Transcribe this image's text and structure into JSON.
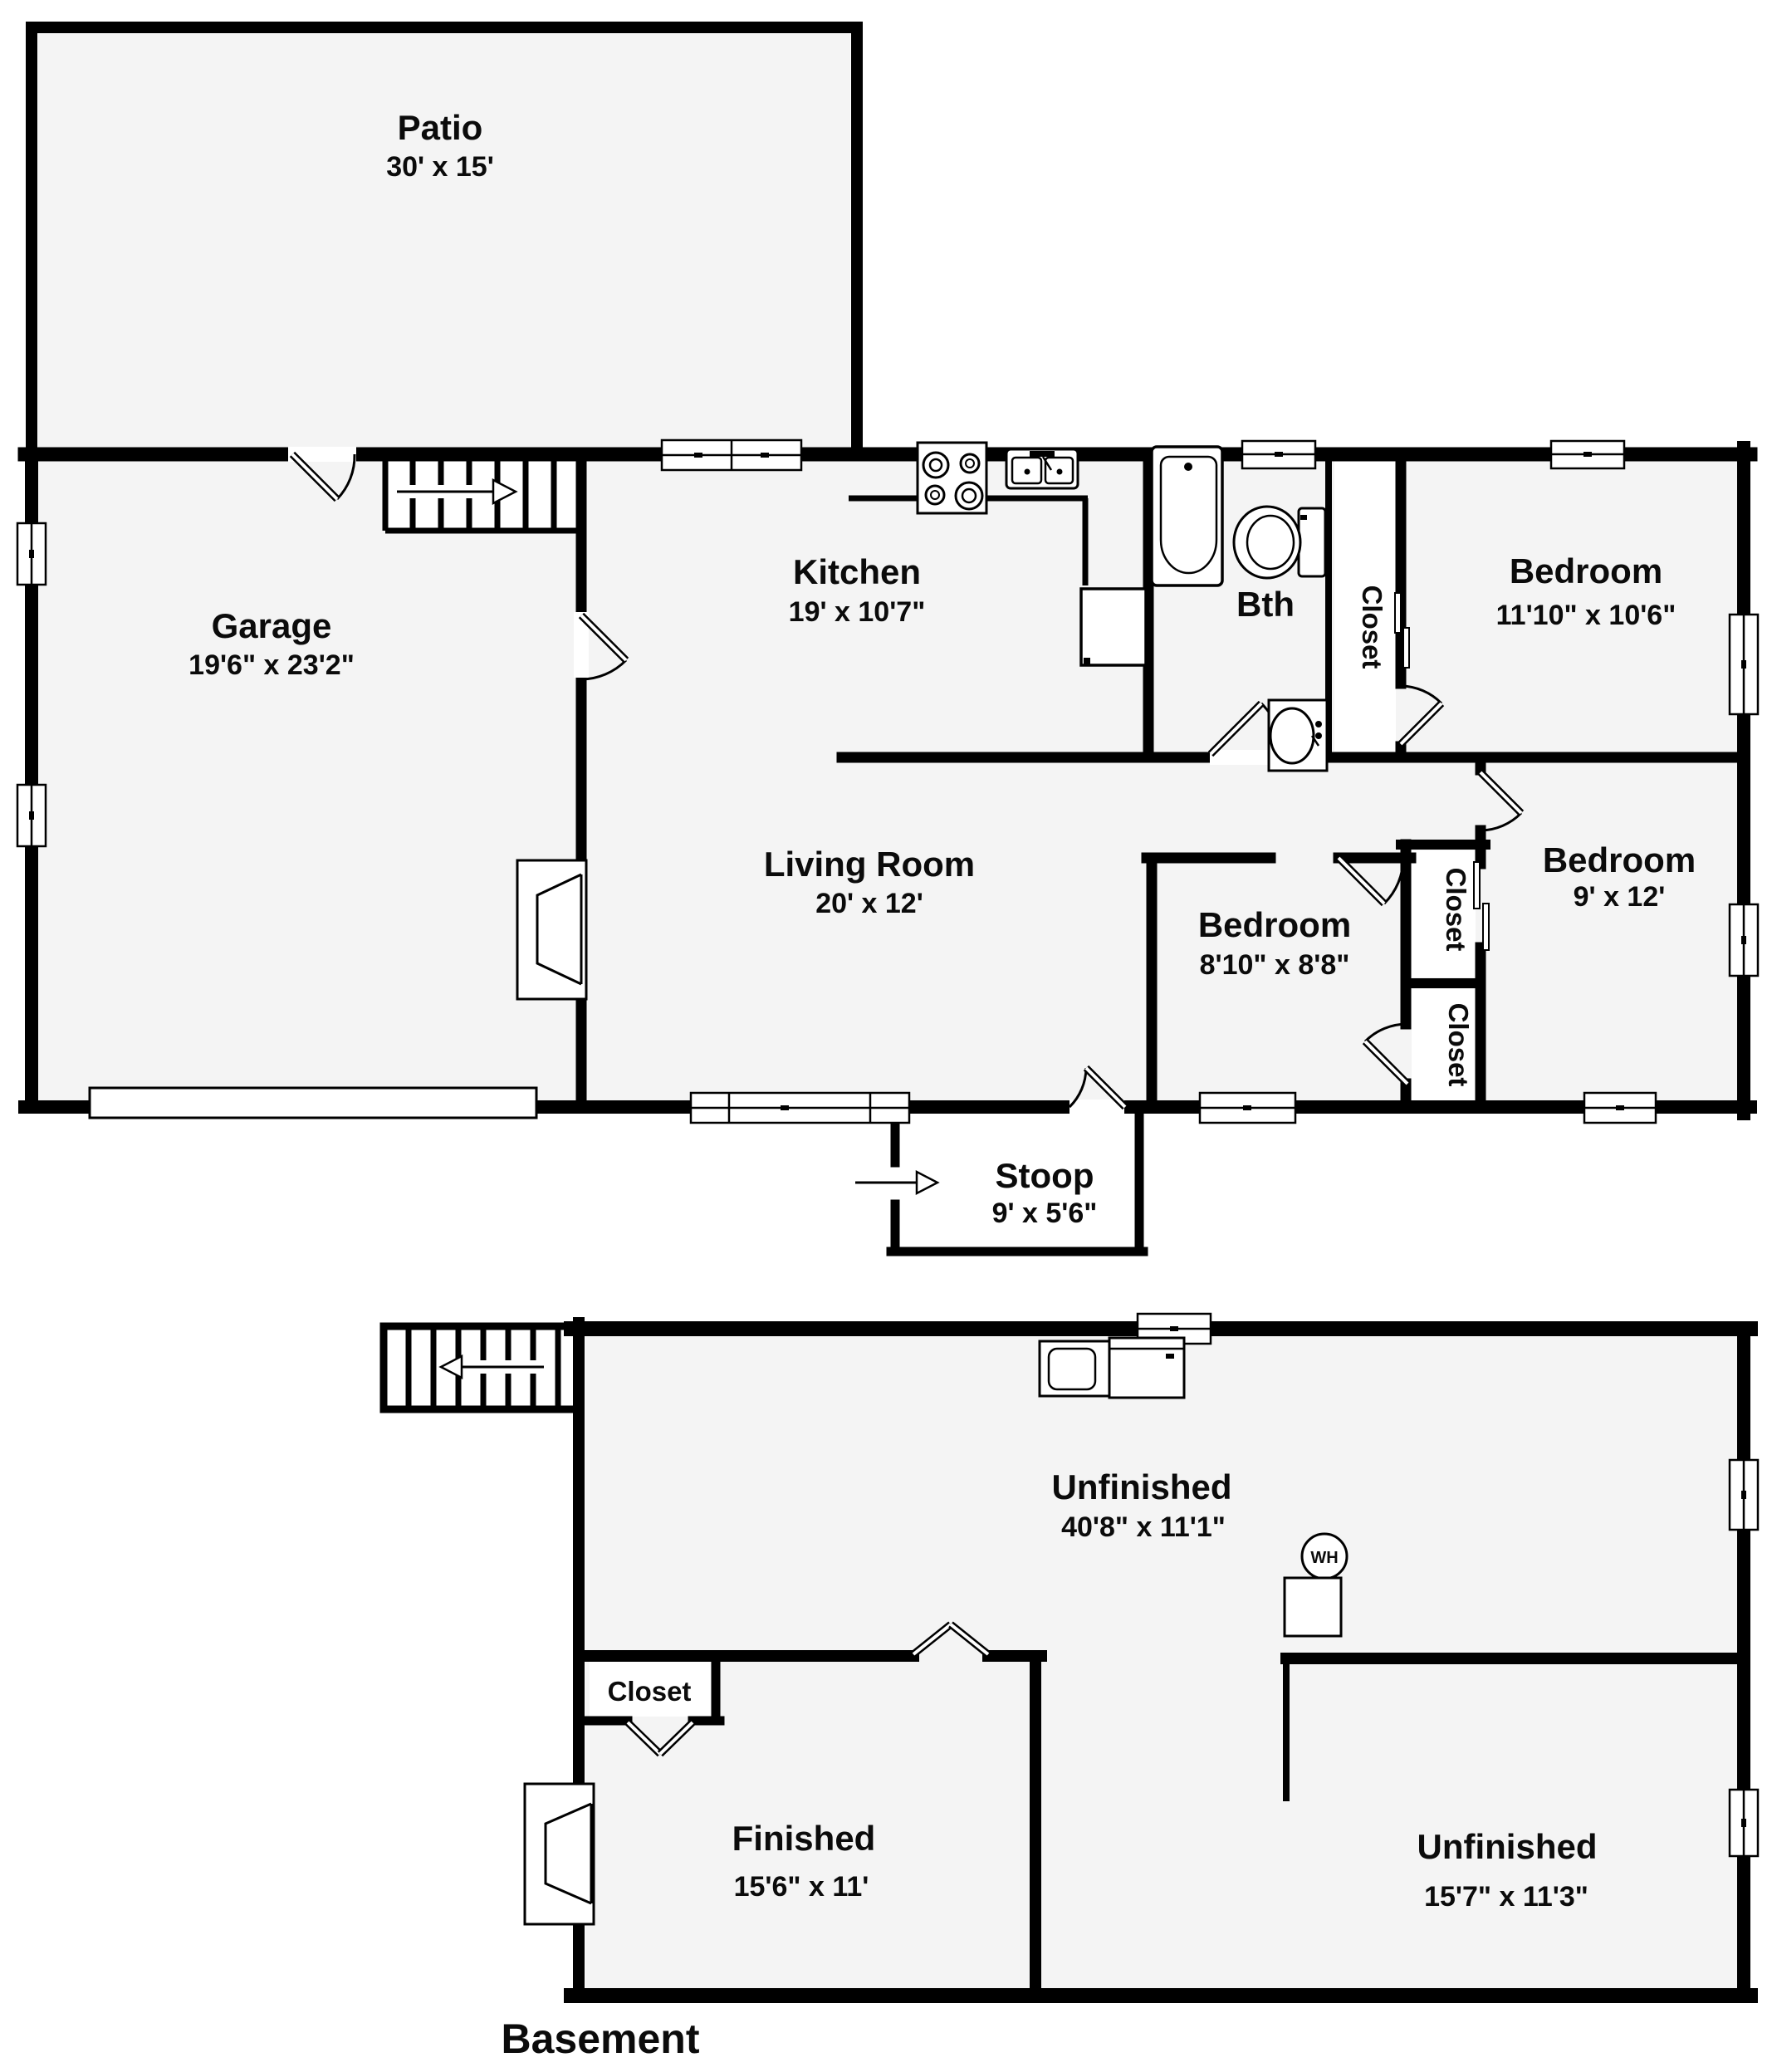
{
  "floor_plan": {
    "title": "Basement",
    "colors": {
      "wall": "#000000",
      "room_fill": "#f4f4f4",
      "background": "#ffffff"
    },
    "rooms": {
      "patio": {
        "name": "Patio",
        "dims": "30' x 15'"
      },
      "garage": {
        "name": "Garage",
        "dims": "19'6\" x 23'2\""
      },
      "kitchen": {
        "name": "Kitchen",
        "dims": "19' x 10'7\""
      },
      "bath": {
        "name": "Bth"
      },
      "bath_closet": {
        "name": "Closet"
      },
      "bedroom_top": {
        "name": "Bedroom",
        "dims": "11'10\" x 10'6\""
      },
      "living_room": {
        "name": "Living Room",
        "dims": "20' x 12'"
      },
      "bedroom_middle": {
        "name": "Bedroom",
        "dims": "8'10\" x 8'8\""
      },
      "closet_upper": {
        "name": "Closet"
      },
      "closet_lower": {
        "name": "Closet"
      },
      "bedroom_right": {
        "name": "Bedroom",
        "dims": "9' x 12'"
      },
      "stoop": {
        "name": "Stoop",
        "dims": "9' x 5'6\""
      },
      "unfinished_main": {
        "name": "Unfinished",
        "dims": "40'8\" x 11'1\""
      },
      "basement_closet": {
        "name": "Closet"
      },
      "finished": {
        "name": "Finished",
        "dims": "15'6\" x 11'"
      },
      "unfinished_lower": {
        "name": "Unfinished",
        "dims": "15'7\" x 11'3\""
      }
    },
    "labels": {
      "floor": "Basement",
      "water_heater": "WH"
    },
    "icons": [
      "stair-arrow-right-icon",
      "stair-arrow-left-icon",
      "entry-arrow-icon",
      "tub-icon",
      "toilet-icon",
      "sink-icon",
      "stove-icon",
      "kitchen-sink-icon",
      "fridge-icon",
      "fireplace-icon",
      "washer-icon",
      "dryer-icon",
      "water-heater-icon",
      "furnace-icon"
    ]
  }
}
